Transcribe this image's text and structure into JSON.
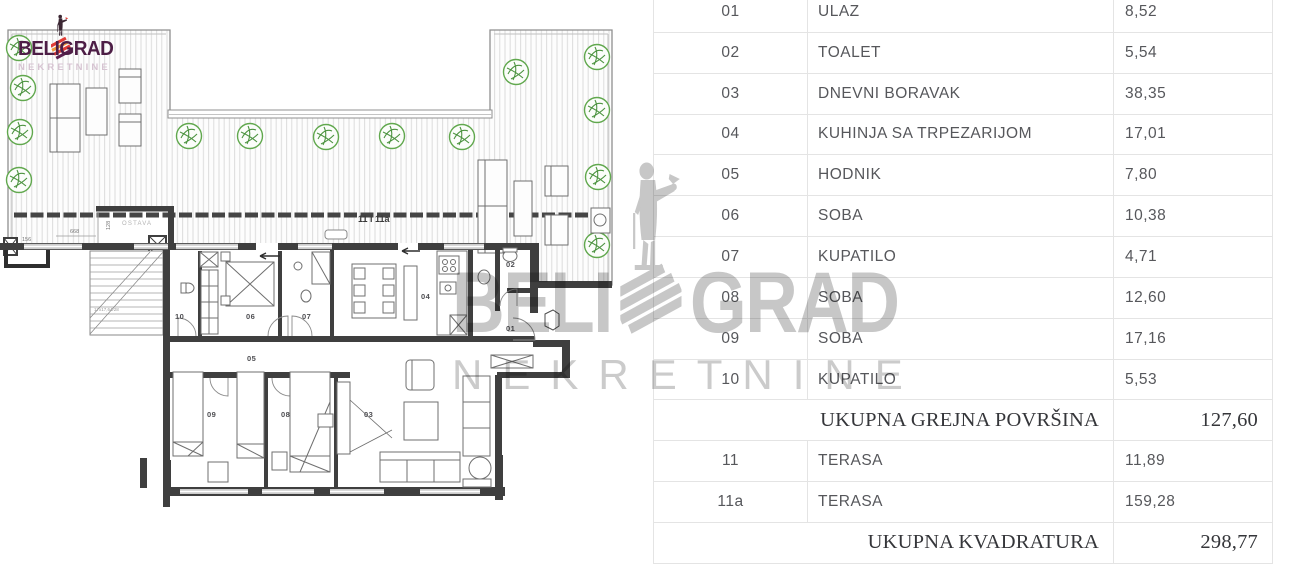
{
  "logo": {
    "brand_left": "BELI",
    "brand_right": "GRAD",
    "subtitle": "NEKRETNINE"
  },
  "watermark": {
    "brand_left": "BELI",
    "brand_right": "GRAD",
    "subtitle": "NEKRETNINE"
  },
  "floor_plan": {
    "area_label": "11 i 11a",
    "storage_label": "OSTAVA",
    "stair_label": "17x17,64/28",
    "dims": {
      "balcony_width": "156",
      "storage_width": "668",
      "storage_depth": "128"
    }
  },
  "colors": {
    "brand": "#4d1e46",
    "watermark_gray": "#c8c8c8",
    "wall": "#3f3f3f",
    "plant_green": "#5aa347",
    "table_border": "#e4e4e4"
  },
  "table": {
    "rows": [
      {
        "type": "item",
        "num": "01",
        "name": "ULAZ",
        "value": "8,52"
      },
      {
        "type": "item",
        "num": "02",
        "name": "TOALET",
        "value": "5,54"
      },
      {
        "type": "item",
        "num": "03",
        "name": "DNEVNI BORAVAK",
        "value": "38,35"
      },
      {
        "type": "item",
        "num": "04",
        "name": "KUHINJA SA TRPEZARIJOM",
        "value": "17,01"
      },
      {
        "type": "item",
        "num": "05",
        "name": "HODNIK",
        "value": "7,80"
      },
      {
        "type": "item",
        "num": "06",
        "name": "SOBA",
        "value": "10,38"
      },
      {
        "type": "item",
        "num": "07",
        "name": "KUPATILO",
        "value": "4,71"
      },
      {
        "type": "item",
        "num": "08",
        "name": "SOBA",
        "value": "12,60"
      },
      {
        "type": "item",
        "num": "09",
        "name": "SOBA",
        "value": "17,16"
      },
      {
        "type": "item",
        "num": "10",
        "name": "KUPATILO",
        "value": "5,53"
      },
      {
        "type": "summary",
        "label": "UKUPNA GREJNA POVRŠINA",
        "value": "127,60"
      },
      {
        "type": "item",
        "num": "11",
        "name": "TERASA",
        "value": "11,89"
      },
      {
        "type": "item",
        "num": "11a",
        "name": "TERASA",
        "value": "159,28"
      },
      {
        "type": "summary",
        "label": "UKUPNA KVADRATURA",
        "value": "298,77"
      }
    ]
  }
}
